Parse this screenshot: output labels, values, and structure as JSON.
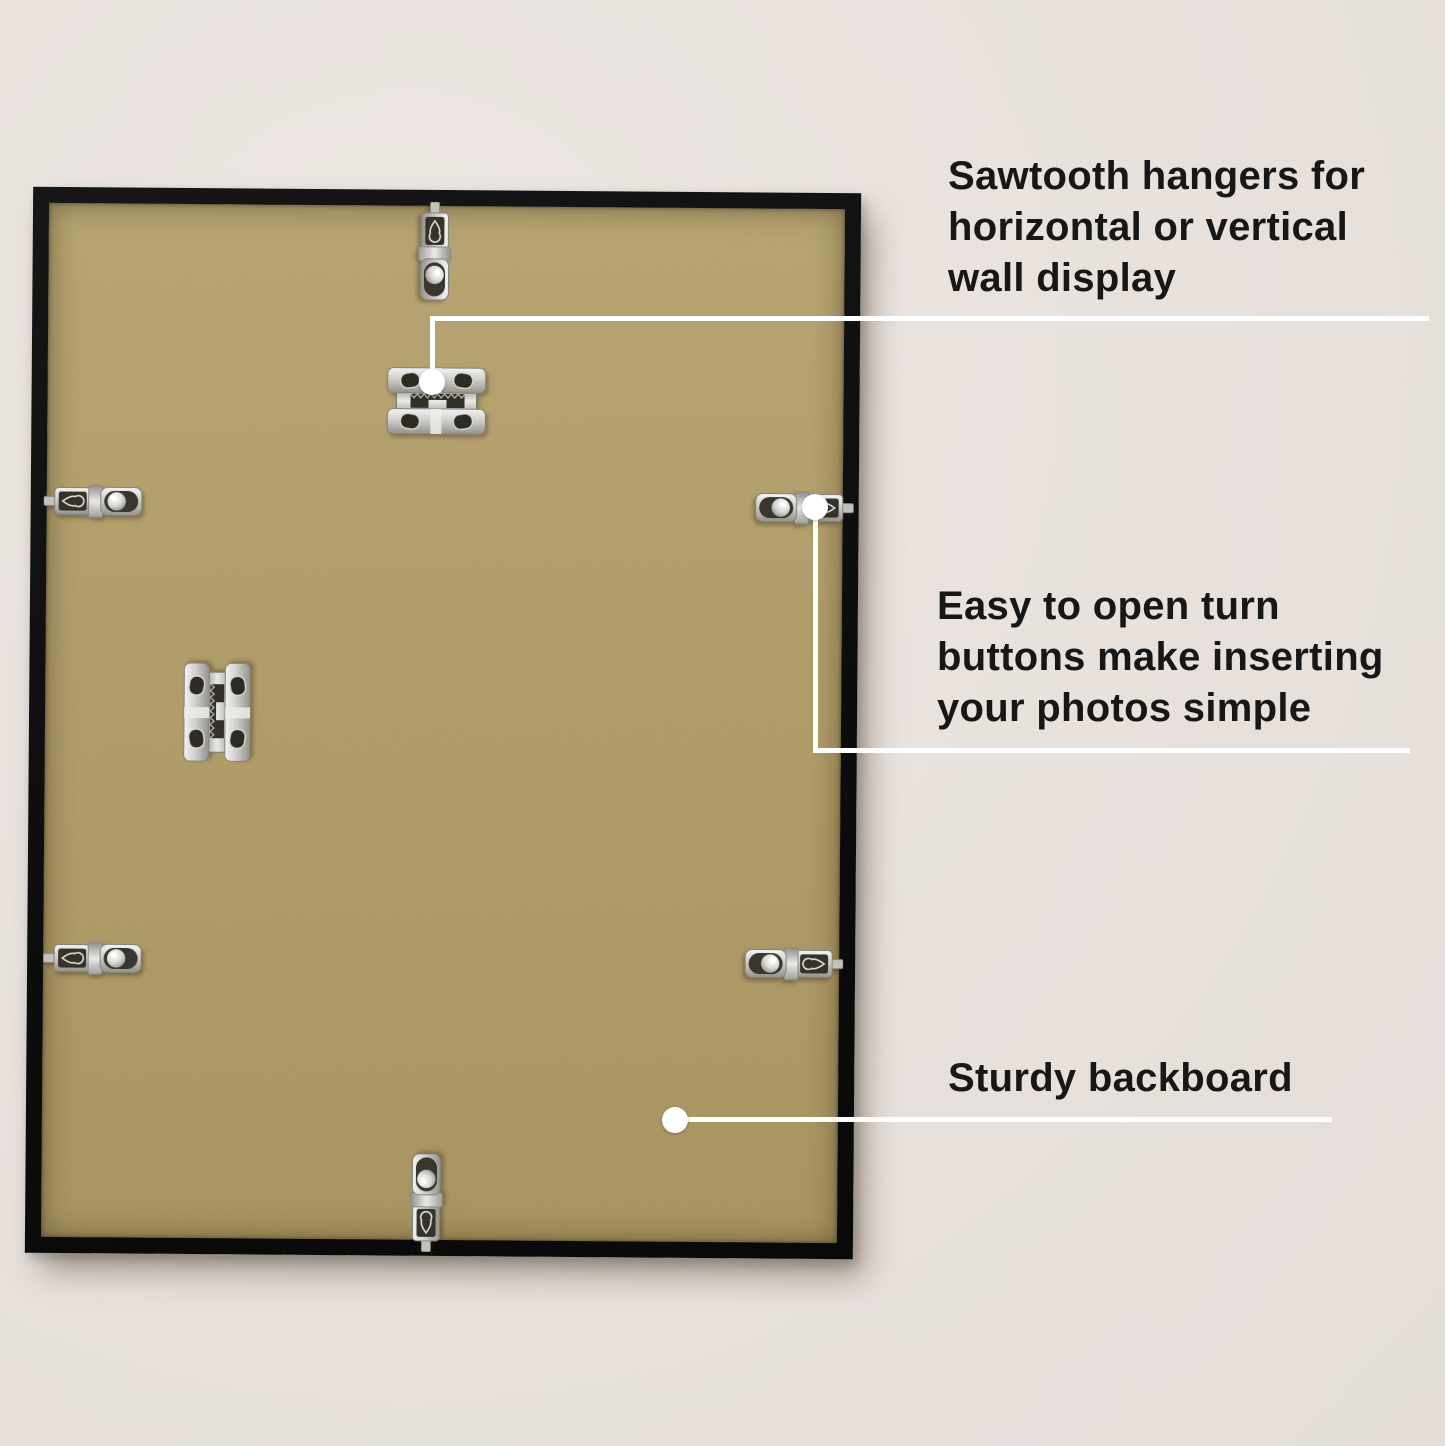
{
  "scene": {
    "description": "Back view of a black picture frame with kraft backboard and metal mounting hardware, annotated with feature callouts",
    "background_color": "#e8e1dc",
    "frame_color": "#0e0e0e",
    "backboard_color": "#b19d6a",
    "callout_color": "#ffffff",
    "text_color": "#171717",
    "metal_color": "#cfcfcd"
  },
  "annotations": [
    {
      "id": "sawtooth-hangers",
      "text": "Sawtooth hangers for horizontal or vertical wall display",
      "lines": [
        "Sawtooth hangers for",
        "horizontal or vertical",
        "wall display"
      ]
    },
    {
      "id": "turn-buttons",
      "text": "Easy to open turn buttons make inserting your photos simple",
      "lines": [
        "Easy to open turn",
        "buttons make inserting",
        "your photos simple"
      ]
    },
    {
      "id": "sturdy-backboard",
      "text": "Sturdy backboard",
      "lines": [
        "Sturdy backboard"
      ]
    }
  ],
  "hardware": {
    "sawtooth_hangers": {
      "count": 2,
      "icon": "sawtooth-hanger-icon"
    },
    "turn_buttons": {
      "count": 6,
      "icon": "turn-button-icon"
    }
  }
}
